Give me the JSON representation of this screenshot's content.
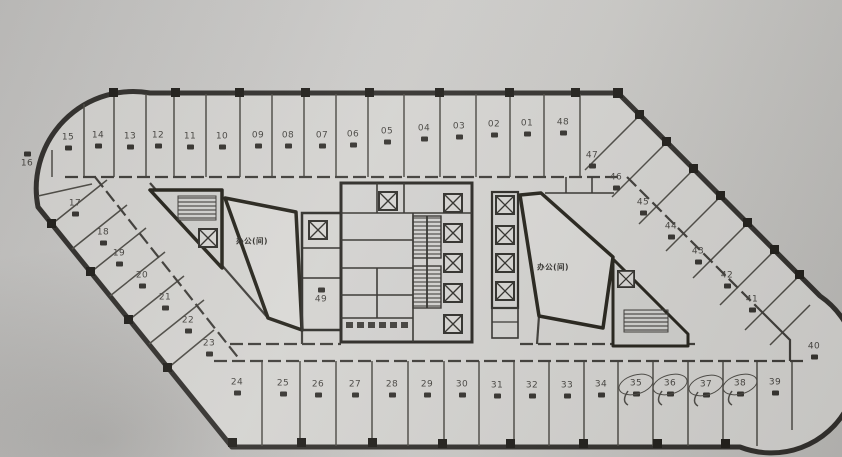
{
  "plan": {
    "units": {
      "top": [
        "15",
        "14",
        "13",
        "12",
        "11",
        "10",
        "09",
        "08",
        "07",
        "06",
        "05",
        "04",
        "03",
        "02",
        "01",
        "48"
      ],
      "left": [
        "16",
        "17",
        "18",
        "19",
        "20",
        "21",
        "22",
        "23"
      ],
      "bottom": [
        "24",
        "25",
        "26",
        "27",
        "28",
        "29",
        "30",
        "31",
        "32",
        "33",
        "34",
        "35",
        "36",
        "37",
        "38",
        "39"
      ],
      "right": [
        "47",
        "46",
        "45",
        "44",
        "43",
        "42",
        "41",
        "40"
      ],
      "inner": "49"
    },
    "hall_labels": {
      "left": "办公(间)",
      "right": "办公(间)"
    },
    "annotations": {
      "circled_units": [
        "35",
        "36",
        "37",
        "38"
      ]
    },
    "colors": {
      "paper": "#d7d6d3",
      "ink": "#34322e"
    }
  }
}
